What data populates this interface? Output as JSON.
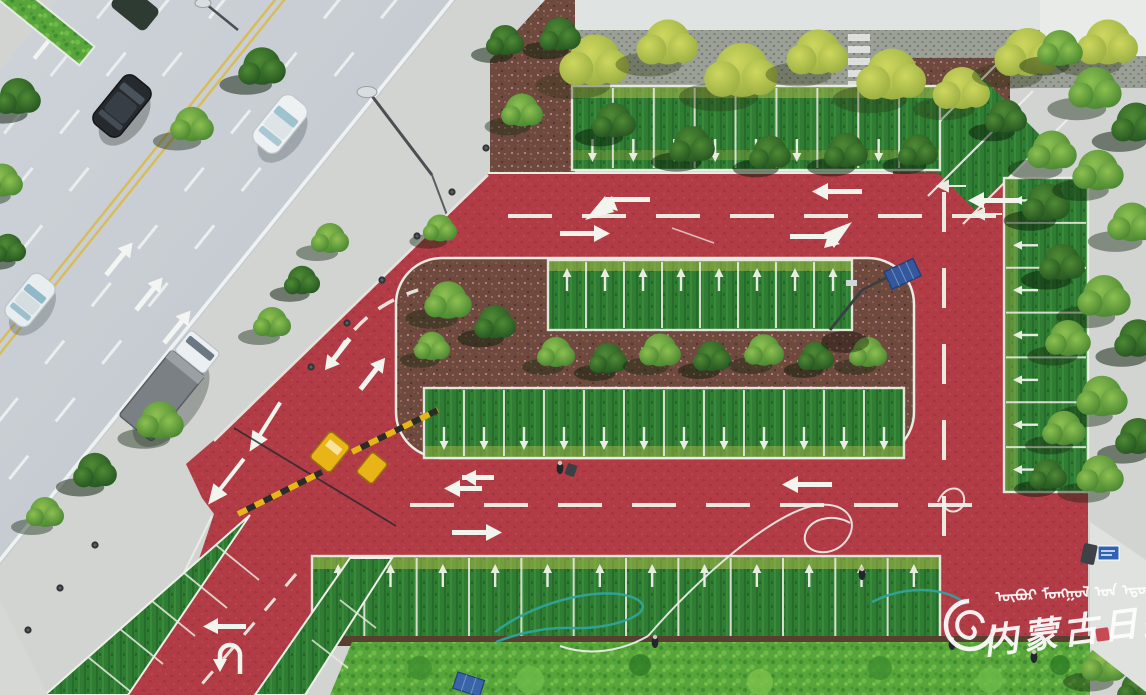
{
  "scene": {
    "subject": "Aerial drone view of a newly built red-surface eco parking lot with grass parking bays beside an urban road",
    "objects": [
      {
        "name": "city-road",
        "lanes": "six-lane with double yellow center line",
        "vehicles": [
          "dark-suv",
          "white-sedan",
          "white-hatchback",
          "white-box-truck"
        ]
      },
      {
        "name": "entrance-barrier-gate",
        "color": "#e8b417"
      },
      {
        "name": "solar-street-lamp",
        "panel_color": "#35589c"
      },
      {
        "name": "garden-hose",
        "color": "#2fa39b"
      },
      {
        "name": "white-hose"
      },
      {
        "name": "workers",
        "count": 5
      }
    ]
  },
  "parking": {
    "top_row": {
      "spaces": 9,
      "arrow": "down"
    },
    "island_top_row": {
      "spaces": 8,
      "arrow": "up"
    },
    "island_bottom_row": {
      "spaces": 12,
      "arrow": "down"
    },
    "right_column": {
      "spaces": 7,
      "arrow": "left"
    },
    "bottom_row": {
      "spaces": 12,
      "arrow": "up"
    },
    "southwest_bays": {
      "spaces": 5,
      "arrow": "none"
    },
    "northeast_diagonal": {
      "spaces": 3,
      "arrow": "left"
    }
  },
  "road_markings": {
    "center_line": "double-yellow",
    "lane_dashes": "white",
    "arrows": [
      "straight",
      "left-turn",
      "right-turn",
      "u-turn",
      "lane-change"
    ]
  },
  "watermark": {
    "mongolian_text": "ᠦᠪᠦᠷ ᠮᠣᠩᠭᠣᠯ ᠤᠨ ᠡᠳᠦᠷ ᠦᠨ ᠰᠣᠨᠢᠨ",
    "chinese_text": "内蒙古日报",
    "color": "#ffffff"
  },
  "colors": {
    "red_asphalt": "#b23c46",
    "grass": "#2f7c33",
    "scorched_grass": "#b7bd4c",
    "hedge": "#58a53c",
    "mulch": "#6e4a3e",
    "road_gray": "#c9cfd4",
    "sidewalk": "#d2d4d2",
    "lane_yellow": "#d8bc58",
    "marking_white": "#f0f3ea",
    "wall_gray": "#9aa096",
    "water_hose": "#2fa39b",
    "barrier_yellow": "#e8b417",
    "solar_panel": "#35589c"
  }
}
